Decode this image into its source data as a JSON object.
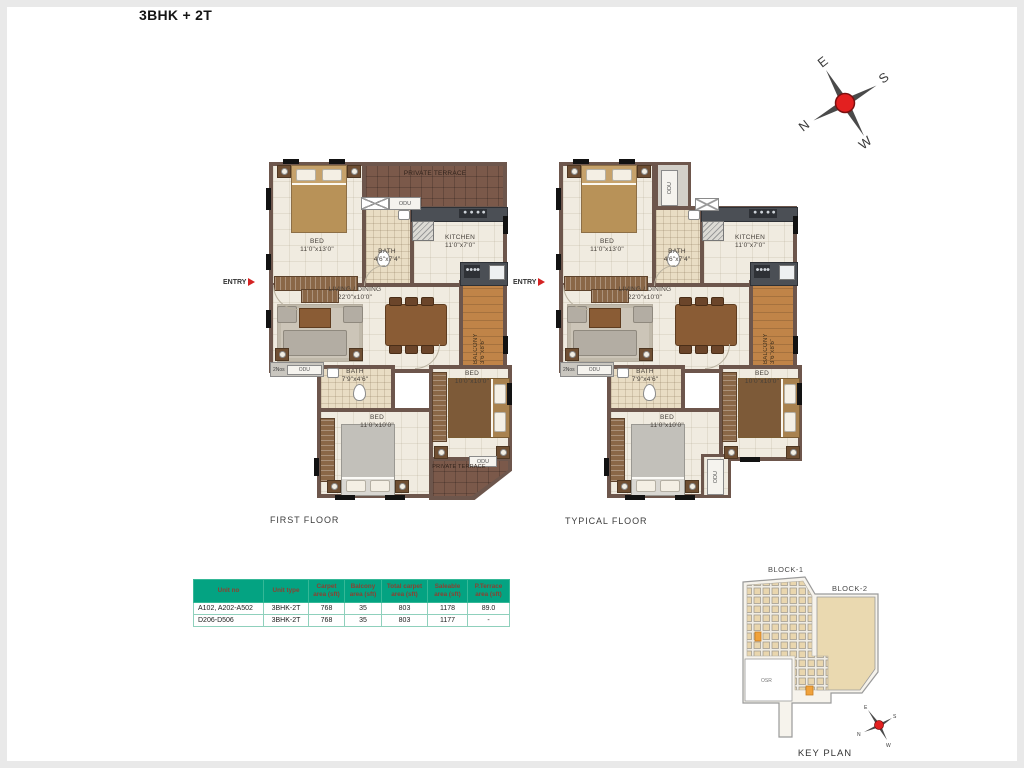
{
  "title": "3BHK + 2T",
  "entry_label": "ENTRY",
  "compass": {
    "n": "N",
    "e": "E",
    "s": "S",
    "w": "W"
  },
  "floors": {
    "first": "FIRST FLOOR",
    "typical": "TYPICAL FLOOR"
  },
  "rooms": {
    "bed1": {
      "name": "BED",
      "dims": "11'0\"x13'0\""
    },
    "bed2": {
      "name": "BED",
      "dims": "11'0\"x10'0\""
    },
    "bed3": {
      "name": "BED",
      "dims": "10'0\"x10'0\""
    },
    "bath1": {
      "name": "BATH",
      "dims": "4'6\"x7'4\""
    },
    "bath2": {
      "name": "BATH",
      "dims": "7'9\"x4'6\""
    },
    "kitchen": {
      "name": "KITCHEN",
      "dims": "11'0\"x7'0\""
    },
    "living": {
      "name": "LIVING / DINING",
      "dims": "22'0\"x10'0\""
    },
    "balcony": {
      "name": "BALCONY",
      "dims": "3'6\"x8'6\""
    },
    "private_terrace": {
      "name": "PRIVATE TERRACE"
    },
    "odu": "ODU",
    "two_nos": "2Nos"
  },
  "table": {
    "headers": [
      "Unit no",
      "Unit type",
      "Carpet area (sft)",
      "Balcony area (sft)",
      "Total carpet area (sft)",
      "Saleable area (sft)",
      "P.Terrace area (sft)"
    ],
    "rows": [
      [
        "A102, A202-A502",
        "3BHK-2T",
        "768",
        "35",
        "803",
        "1178",
        "89.0"
      ],
      [
        "D206-D506",
        "3BHK-2T",
        "768",
        "35",
        "803",
        "1177",
        "-"
      ]
    ]
  },
  "key_plan": {
    "block1": "BLOCK-1",
    "block2": "BLOCK-2",
    "osr": "OSR",
    "label": "KEY PLAN"
  }
}
